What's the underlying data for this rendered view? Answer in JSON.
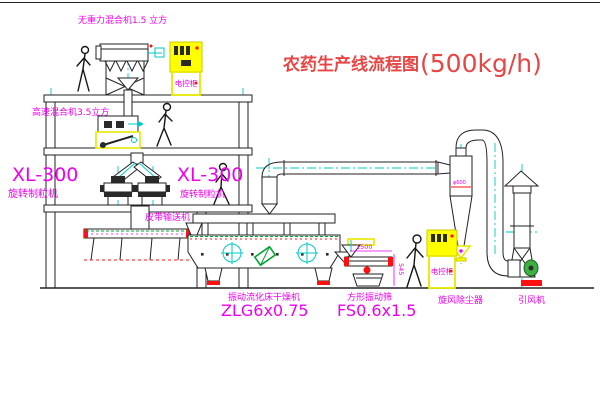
{
  "title": {
    "text": "农药生产线流程图",
    "capacity": "(500kg/h)"
  },
  "labels": {
    "gravity_free_mixer": "无重力混合机1.5 立方",
    "high_speed_mixer": "高速混合机3.5立方",
    "granulator_left_model": "XL-300",
    "granulator_left_name": "旋转制粒机",
    "granulator_right_model": "XL-300",
    "granulator_right_name": "旋转制粒机",
    "belt_conveyor": "皮带输送机",
    "dryer_name": "振动流化床干燥机",
    "dryer_model": "ZLG6x0.75",
    "screen_name": "方形振动筛",
    "screen_model": "FS0.6x1.5",
    "cyclone": "旋风除尘器",
    "fan": "引风机",
    "control_cabinet": "电控柜"
  },
  "dims": {
    "screen_length": "1500",
    "screen_height": "545",
    "cyclone_note": "φ600"
  },
  "colors": {
    "label_magenta": "#ee00ee",
    "title_red": "#e84545",
    "centerline_cyan": "#00c8c8",
    "line_black": "#222222",
    "highlight_yellow": "#ffff00",
    "accent_red": "#ff1010",
    "accent_green": "#00a432"
  }
}
